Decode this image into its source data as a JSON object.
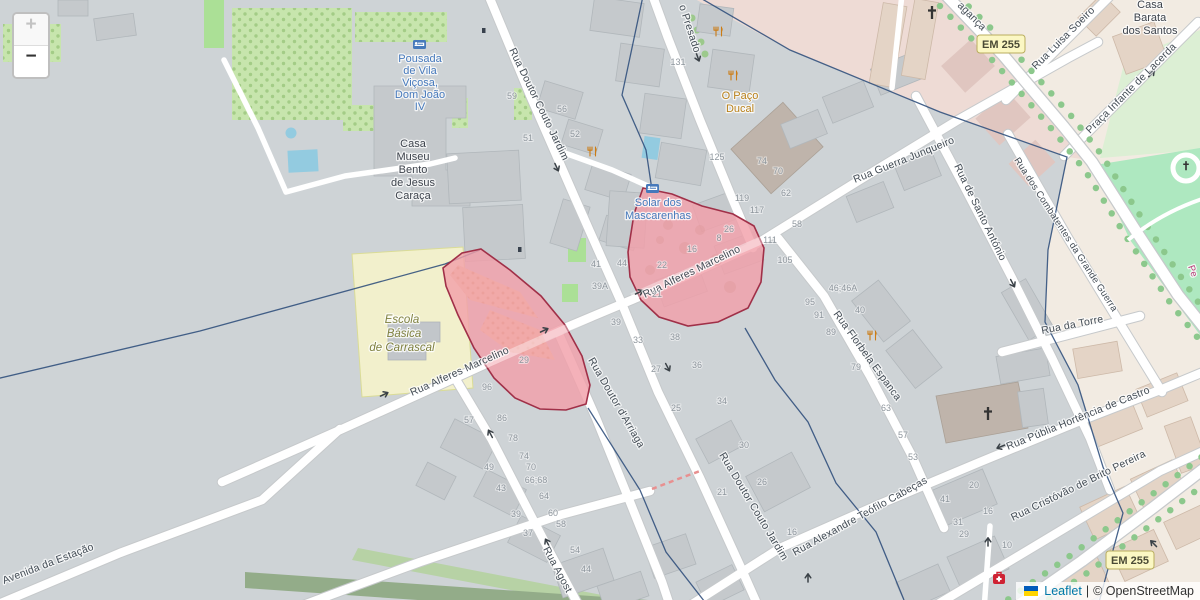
{
  "controls": {
    "zoom_in_label": "+",
    "zoom_out_label": "−"
  },
  "attribution": {
    "leaflet": "Leaflet",
    "separator": "|",
    "copyright": "© OpenStreetMap"
  },
  "streets": {
    "couto_jardim": "Rua Doutor Couto Jardim",
    "presado": "o Presado",
    "alferes_marcelino": "Rua Alferes Marcelino",
    "guerra_junqueiro": "Rua Guerra Junqueiro",
    "santo_antonio": "Rua de Santo António",
    "combatentes": "Rua dos Combatentes da Grande Guerra",
    "torre": "Rua da Torre",
    "florbela_espanca": "Rua Florbela Espanca",
    "arriaga": "Rua Doutor d'Arriaga",
    "agostinho": "Rua Agost",
    "teofilo_cabecas": "Rua Alexandre Teófilo Cabeças",
    "hortencia": "Rua Públia Hortência de Castro",
    "cristovao": "Rua Cristóvão de Brito Pereira",
    "estacao": "Avenida da Estação",
    "luisa_soeiro": "Rua Luisa Soeiro",
    "infante_lacerda": "Praça Infante de Lacerda",
    "braganca_fragment": "agança",
    "pe_fragment": "Pe",
    "em255": "EM 255"
  },
  "pois": {
    "pousada": {
      "lines": [
        "Pousada",
        "de Vila",
        "Viçosa,",
        "Dom João",
        "IV"
      ]
    },
    "casa_museu": {
      "lines": [
        "Casa",
        "Museu",
        "Bento",
        "de Jesus",
        "Caraça"
      ]
    },
    "paco_ducal": {
      "lines": [
        "O Paço",
        "Ducal"
      ]
    },
    "solar": {
      "lines": [
        "Solar dos",
        "Mascarenhas"
      ]
    },
    "escola": {
      "lines": [
        "Escola",
        "Básica",
        "de Carrascal"
      ]
    },
    "casa_barata": {
      "lines": [
        "Casa",
        "Barata",
        "dos Santos"
      ]
    }
  },
  "house_numbers": [
    [
      "59",
      512,
      99
    ],
    [
      "51",
      528,
      141
    ],
    [
      "56",
      562,
      112
    ],
    [
      "52",
      575,
      137
    ],
    [
      "131",
      678,
      65
    ],
    [
      "125",
      717,
      160
    ],
    [
      "74",
      762,
      164
    ],
    [
      "70",
      778,
      174
    ],
    [
      "62",
      786,
      196
    ],
    [
      "119",
      742,
      201
    ],
    [
      "117",
      757,
      213
    ],
    [
      "58",
      797,
      227
    ],
    [
      "111",
      770,
      243
    ],
    [
      "105",
      785,
      263
    ],
    [
      "26",
      729,
      232
    ],
    [
      "8",
      719,
      241
    ],
    [
      "16",
      692,
      252
    ],
    [
      "22",
      662,
      268
    ],
    [
      "21",
      657,
      297
    ],
    [
      "44",
      622,
      266
    ],
    [
      "41",
      596,
      267
    ],
    [
      "39A",
      600,
      289
    ],
    [
      "39",
      616,
      325
    ],
    [
      "33",
      638,
      343
    ],
    [
      "38",
      675,
      340
    ],
    [
      "27",
      656,
      372
    ],
    [
      "36",
      697,
      368
    ],
    [
      "25",
      676,
      411
    ],
    [
      "34",
      722,
      404
    ],
    [
      "30",
      744,
      448
    ],
    [
      "26",
      762,
      485
    ],
    [
      "21",
      722,
      495
    ],
    [
      "16",
      792,
      535
    ],
    [
      "46;46A",
      843,
      291
    ],
    [
      "40",
      860,
      313
    ],
    [
      "95",
      810,
      305
    ],
    [
      "91",
      819,
      318
    ],
    [
      "89",
      831,
      335
    ],
    [
      "79",
      856,
      370
    ],
    [
      "63",
      886,
      411
    ],
    [
      "57",
      903,
      438
    ],
    [
      "53",
      913,
      460
    ],
    [
      "41",
      945,
      502
    ],
    [
      "31",
      958,
      525
    ],
    [
      "29",
      964,
      537
    ],
    [
      "20",
      974,
      488
    ],
    [
      "16",
      988,
      514
    ],
    [
      "10",
      1007,
      548
    ],
    [
      "96",
      487,
      390
    ],
    [
      "57",
      469,
      423
    ],
    [
      "86",
      502,
      421
    ],
    [
      "78",
      513,
      441
    ],
    [
      "74",
      524,
      459
    ],
    [
      "70",
      531,
      470
    ],
    [
      "66;68",
      536,
      483
    ],
    [
      "64",
      544,
      499
    ],
    [
      "49",
      489,
      470
    ],
    [
      "43",
      501,
      491
    ],
    [
      "39",
      516,
      517
    ],
    [
      "37",
      528,
      536
    ],
    [
      "60",
      553,
      516
    ],
    [
      "58",
      561,
      527
    ],
    [
      "54",
      575,
      553
    ],
    [
      "44",
      586,
      572
    ],
    [
      "29",
      524,
      363
    ]
  ],
  "colors": {
    "highlight_fill": "#f2a0a9",
    "highlight_border": "#a03048",
    "boundary": "#2e4d7b",
    "school_fill": "#f2f0cc",
    "road_yellow": "#f6f2bb",
    "park_green": "#aee8c0",
    "link_blue": "#0078A8"
  }
}
